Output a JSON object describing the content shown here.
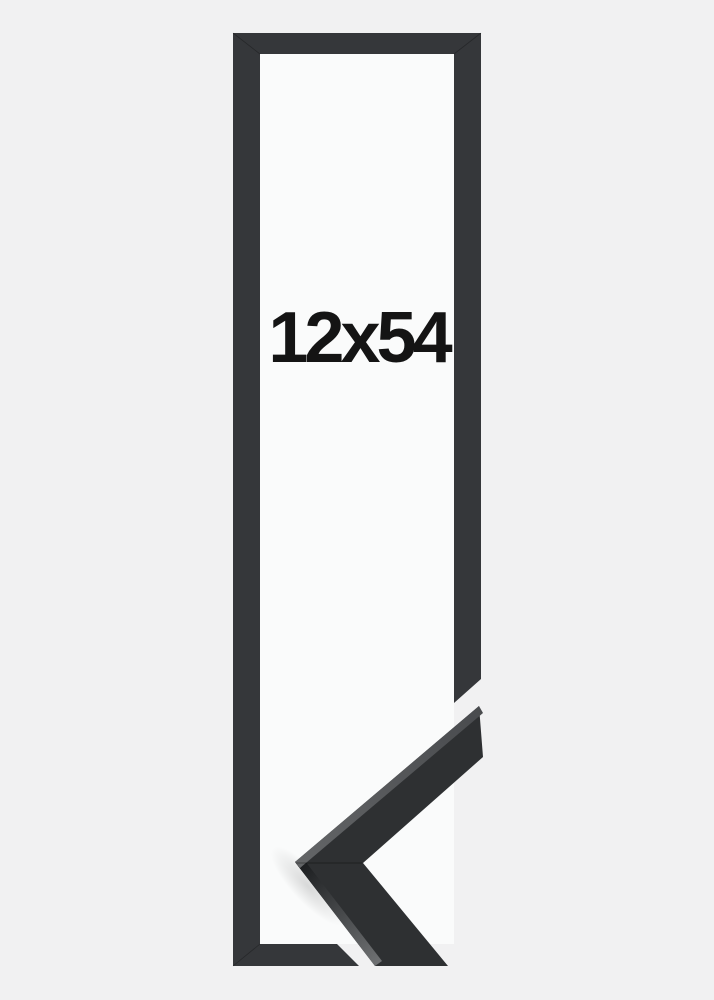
{
  "product": {
    "size_label": "12x54"
  },
  "colors": {
    "background": "#f1f1f2",
    "frame": "#35373a",
    "frame_interior": "#fafbfb",
    "sample_face": "#2e3032",
    "sample_edge_light": "#707274",
    "sample_edge_dark": "#17191b",
    "label_text": "#141414"
  }
}
